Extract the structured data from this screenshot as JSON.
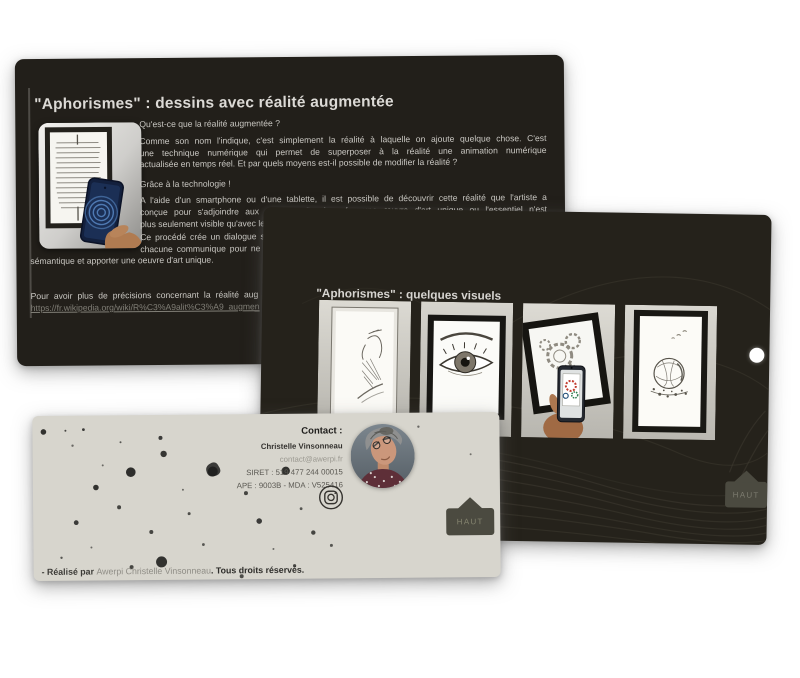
{
  "colors": {
    "dark_card": "#23201b",
    "light_card": "#d7d5cd",
    "haut_button": "#4b4a40",
    "link_gray": "#817f77",
    "nav_dot": "#ffffff"
  },
  "icons": {
    "instagram": "instagram-camera-icon",
    "nav_dot": "carousel-dot",
    "haut_arrow": "up-arrow-tab"
  },
  "slide1": {
    "title": "\"Aphorismes\" : dessins avec réalité augmentée",
    "q1": "Qu'est-ce que la réalité augmentée ?",
    "p2_lines": [
      "Comme son nom l'indique, c'est simplement la réalité à laquelle on ajoute quelque chose. C'est",
      "une technique numérique qui permet de superposer à la réalité une animation numérique",
      "actualisée en temps réel. Et par quels moyens est-il possible de modifier la réalité ?"
    ],
    "p3": "Grâce à la technologie !",
    "p4_lines": [
      "A l'aide d'un smartphone ou d'une tablette, il est possible de découvrir cette réalité que l'artiste a",
      "conçue pour s'adjoindre aux dessins afin de créer une œuvre d'art unique ou l'essentiel n'est",
      "plus seulement visible qu'avec les yeux."
    ],
    "p5_line1": "Ce procédé crée un dialogue s",
    "p5_line2": "chacune communique pour ne",
    "p5_line3": "sémantique et apporter une oeuvre d'art unique.",
    "more_info": "Pour avoir plus de précisions concernant la réalité aug",
    "link": "https://fr.wikipedia.org/wiki/R%C3%A9alit%C3%A9_augmen"
  },
  "slide2": {
    "title": "\"Aphorismes\" : quelques visuels",
    "haut_label": "HAUT",
    "artworks": [
      "framed-portrait-drawing",
      "framed-eye-drawing",
      "framed-gears-drawing-with-smartphone",
      "framed-sphere-splash-drawing"
    ]
  },
  "slide3": {
    "contact_label": "Contact :",
    "name": "Christelle Vinsonneau",
    "email": "contact@awerpi.fr",
    "siret": "SIRET : 519 477 244 00015",
    "ape": "APE : 9003B - MDA : V525416",
    "haut_label": "HAUT",
    "footer_prefix": "- Réalisé par ",
    "footer_link": "Awerpi Christelle Vinsonneau",
    "footer_suffix": ". Tous droits réservés."
  }
}
